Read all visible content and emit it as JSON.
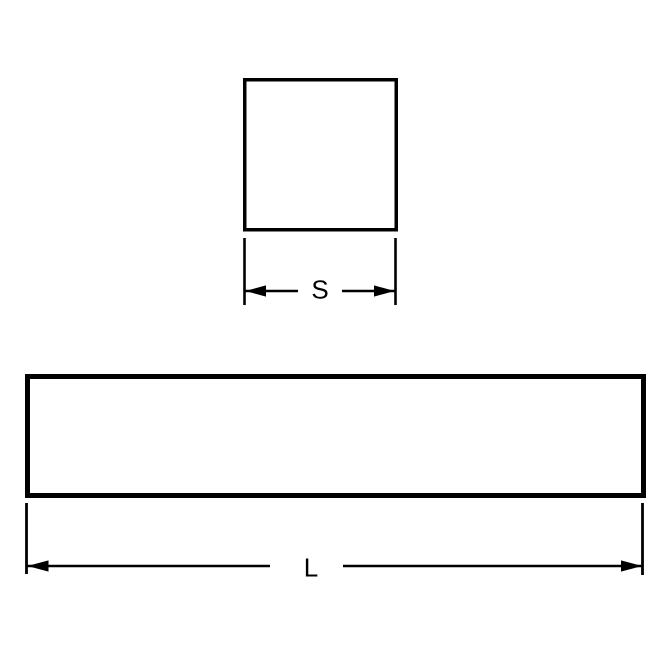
{
  "page": {
    "background": "#ffffff"
  },
  "diagram": {
    "labels": {
      "side": "S",
      "length": "L"
    },
    "colors": {
      "line": "#000000",
      "shape_fill": "#ffffff"
    }
  }
}
